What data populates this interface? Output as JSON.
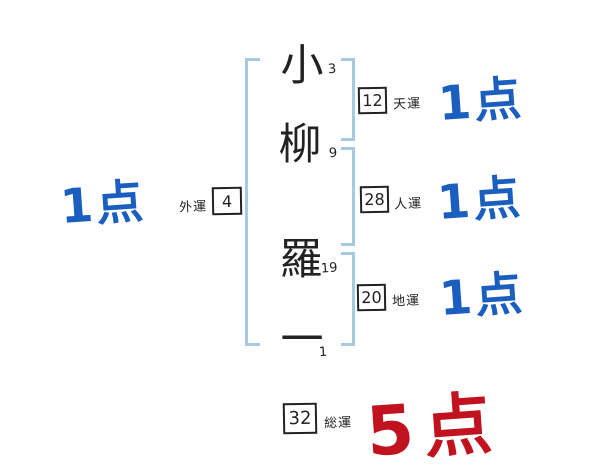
{
  "diagram": {
    "title": "name-fortune-stroke-diagram",
    "name": {
      "characters": [
        {
          "char": "小",
          "strokes": "3"
        },
        {
          "char": "柳",
          "strokes": "9"
        },
        {
          "char": "羅",
          "strokes": "19"
        },
        {
          "char": "一",
          "strokes": "1"
        }
      ]
    },
    "luck": {
      "heaven": {
        "label": "天運",
        "value": "12",
        "score": "1点"
      },
      "person": {
        "label": "人運",
        "value": "28",
        "score": "1点"
      },
      "earth": {
        "label": "地運",
        "value": "20",
        "score": "1点"
      },
      "outer": {
        "label": "外運",
        "value": "4",
        "score": "1点"
      },
      "total": {
        "label": "総運",
        "value": "32",
        "score": "5点"
      }
    },
    "colors": {
      "score_blue": "#1a5fc0",
      "score_red": "#c1121f",
      "bracket_light_blue": "#a6cbde",
      "ink_black": "#222222",
      "background": "#ffffff"
    }
  }
}
